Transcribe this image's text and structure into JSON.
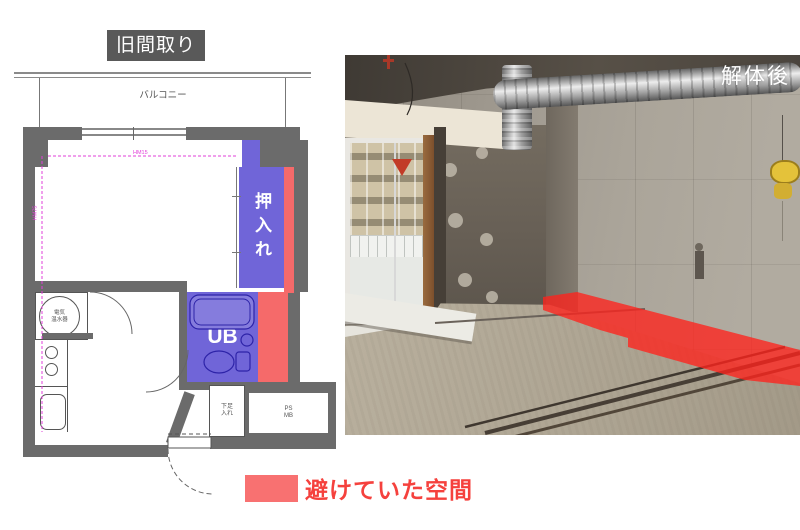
{
  "badge": {
    "label": "旧間取り"
  },
  "photo": {
    "label": "解体後"
  },
  "legend": {
    "label": "避けていた空間",
    "swatch_color": "#f87171",
    "text_color": "#f5413d"
  },
  "plan": {
    "balcony_label": "バルコニー",
    "closet_label": "押入れ",
    "unit_bath_label": "UB",
    "water_heater": {
      "line1": "電気",
      "line2": "温水器"
    },
    "shoe_storage": {
      "line1": "下足",
      "line2": "入れ"
    },
    "pipe_shaft": {
      "line1": "PS",
      "line2": "MB"
    },
    "dim_horizontal": "HM15",
    "dim_vertical": "HM75"
  },
  "colors": {
    "badge_bg": "#595959",
    "wall_gray": "#6b6b6b",
    "zone_purple": "#7065d8",
    "zone_red": "#f56a6a",
    "overlay_red": "#ff231c",
    "dim_magenta": "#e23fd9"
  }
}
